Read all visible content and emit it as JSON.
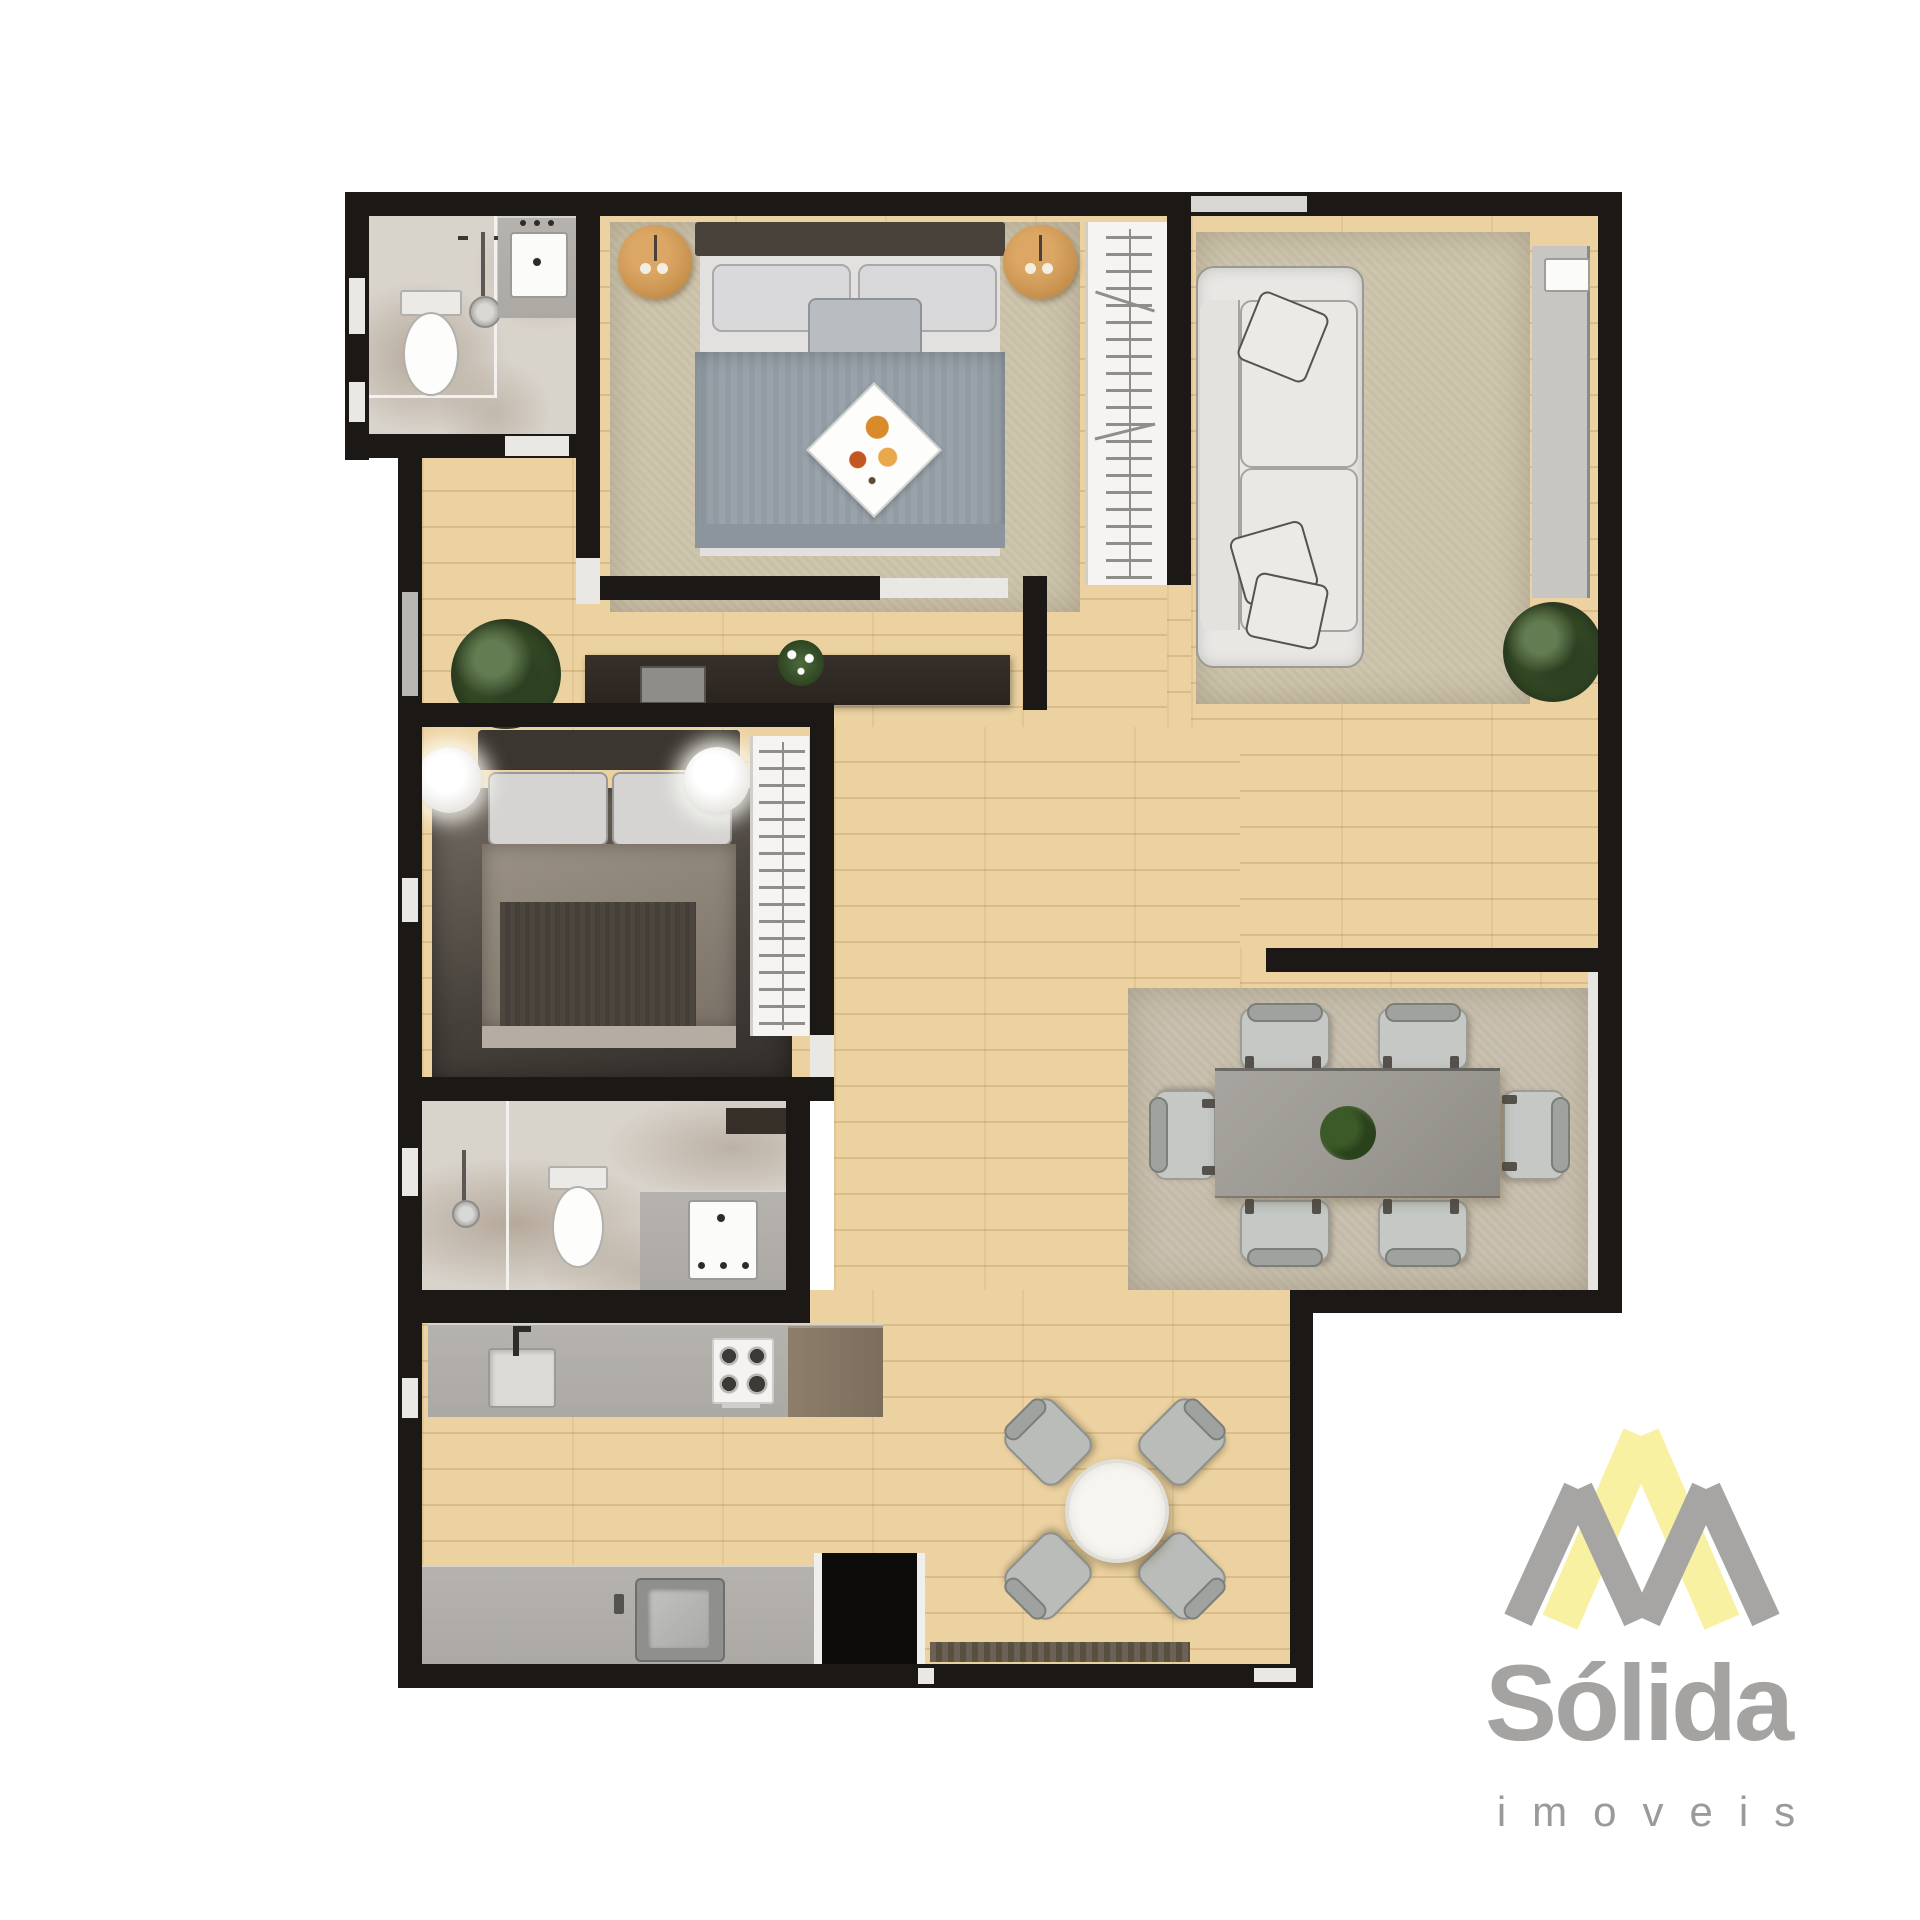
{
  "brand": {
    "name": "Sólida",
    "tagline": "imoveis"
  },
  "palette": {
    "background": "#ffffff",
    "wall": "#1c1815",
    "wood_floor": "#ecd2a0",
    "tile_floor": "#d8d3cb",
    "rug_beige": "#cec5ad",
    "rug_dining": "#c9c0ae",
    "counter_gray": "#b6b3ae",
    "cabinet_brown": "#8d7e6b",
    "console_dark": "#37302a",
    "sofa_cream": "#e8e7e4",
    "bed1_duvet": "#9aa3ab",
    "bed2_duvet": "#8d8478",
    "nightstand_wood": "#ca9450",
    "chair_gray": "#c5c8c4",
    "table_concrete": "#9d9a94",
    "plant_green": "#3f5a33",
    "logo_yellow": "#f8f1a1",
    "logo_gray": "#a6a5a3",
    "logo_text_gray": "#a4a3a1"
  },
  "floorplan": {
    "type": "apartment-top-view-render",
    "rooms": [
      "suite-bathroom",
      "bedroom-1",
      "living-room",
      "hallway",
      "bedroom-2",
      "bathroom-2-laundry",
      "kitchen",
      "dining-area",
      "breakfast-terrace"
    ],
    "furniture": [
      "shower",
      "vanity-sink",
      "toilet",
      "double-bed-1",
      "nightstand-lamps",
      "breakfast-tray",
      "open-wardrobe-1",
      "sofa",
      "tv-panel",
      "plants",
      "media-console",
      "double-bed-2",
      "bedside-lamps",
      "open-wardrobe-2",
      "laundry-tub",
      "kitchen-sink",
      "gas-cooktop",
      "steel-sink",
      "dining-table-6-chairs",
      "round-table-4-chairs",
      "doormat"
    ]
  }
}
